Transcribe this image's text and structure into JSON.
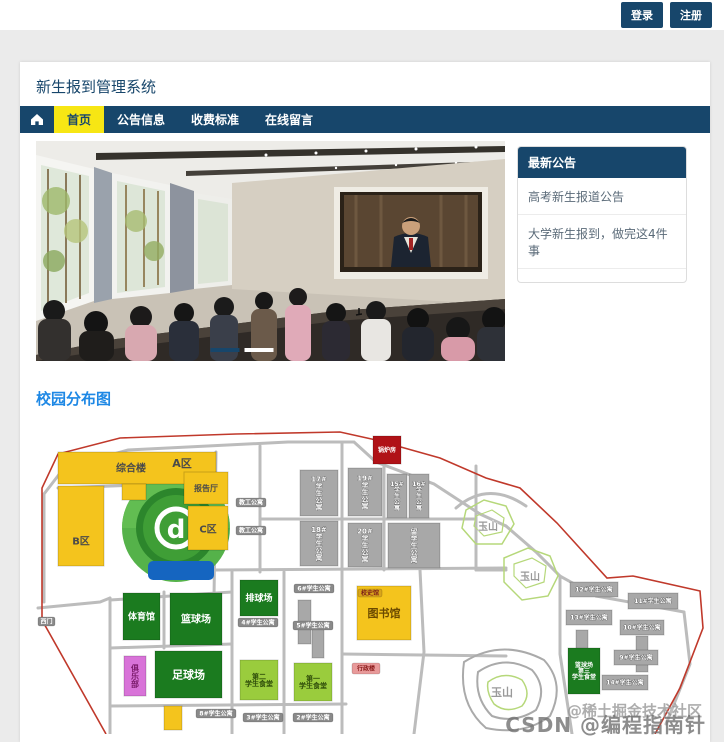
{
  "topbar": {
    "login": "登录",
    "register": "注册"
  },
  "header": {
    "title": "新生报到管理系统"
  },
  "nav": {
    "items": [
      {
        "label": "首页",
        "active": true
      },
      {
        "label": "公告信息",
        "active": false
      },
      {
        "label": "收费标准",
        "active": false
      },
      {
        "label": "在线留言",
        "active": false
      }
    ]
  },
  "carousel": {
    "slide_count": 2,
    "active_slide": 1
  },
  "announcements": {
    "title": "最新公告",
    "items": [
      "高考新生报道公告",
      "大学新生报到，做完这4件事"
    ]
  },
  "map_section": {
    "title": "校园分布图"
  },
  "campus_map": {
    "buildings": [
      {
        "x": 22,
        "y": 30,
        "w": 158,
        "h": 32,
        "c": "y"
      },
      {
        "x": 22,
        "y": 64,
        "w": 46,
        "h": 80,
        "c": "y"
      },
      {
        "x": 86,
        "y": 62,
        "w": 24,
        "h": 16,
        "c": "y"
      },
      {
        "x": 148,
        "y": 50,
        "w": 44,
        "h": 32,
        "c": "y"
      },
      {
        "x": 152,
        "y": 84,
        "w": 40,
        "h": 44,
        "c": "y"
      },
      {
        "l": "综合楼",
        "x": 95,
        "y": 46,
        "c": "ty",
        "fs": 10
      },
      {
        "l": "A区",
        "x": 146,
        "y": 41,
        "c": "ty",
        "fs": 11
      },
      {
        "l": "报告厅",
        "x": 170,
        "y": 66,
        "c": "ty",
        "fs": 8
      },
      {
        "l": "C区",
        "x": 172,
        "y": 107,
        "c": "ty",
        "fs": 10
      },
      {
        "l": "B区",
        "x": 45,
        "y": 119,
        "c": "ty",
        "fs": 10
      },
      {
        "l": "锅炉房",
        "x": 337,
        "y": 14,
        "w": 28,
        "h": 28,
        "c": "r",
        "fs": 6
      },
      {
        "l": "17#学生公寓",
        "x": 264,
        "y": 48,
        "w": 38,
        "h": 46,
        "c": "g",
        "v": 1,
        "fs": 7
      },
      {
        "l": "19#学生公寓",
        "x": 312,
        "y": 46,
        "w": 34,
        "h": 48,
        "c": "g",
        "v": 1,
        "fs": 7
      },
      {
        "l": "15#学生公寓",
        "x": 351,
        "y": 52,
        "w": 20,
        "h": 44,
        "c": "g",
        "v": 1,
        "fs": 6
      },
      {
        "l": "16#学生公寓",
        "x": 373,
        "y": 52,
        "w": 20,
        "h": 44,
        "c": "g",
        "v": 1,
        "fs": 6
      },
      {
        "l": "18#学生公寓",
        "x": 264,
        "y": 99,
        "w": 38,
        "h": 45,
        "c": "g",
        "v": 1,
        "fs": 7
      },
      {
        "l": "20#学生公寓",
        "x": 312,
        "y": 101,
        "w": 34,
        "h": 44,
        "c": "g",
        "v": 1,
        "fs": 7
      },
      {
        "l": "留学生公寓",
        "x": 352,
        "y": 101,
        "w": 52,
        "h": 45,
        "c": "g",
        "v": 1,
        "fs": 7
      },
      {
        "x": 262,
        "y": 178,
        "w": 13,
        "h": 44,
        "c": "g"
      },
      {
        "x": 276,
        "y": 204,
        "w": 12,
        "h": 32,
        "c": "g"
      },
      {
        "x": 540,
        "y": 208,
        "w": 12,
        "h": 36,
        "c": "g"
      },
      {
        "x": 600,
        "y": 214,
        "w": 12,
        "h": 36,
        "c": "g"
      },
      {
        "l": "12#学生公寓",
        "x": 534,
        "y": 160,
        "w": 48,
        "h": 15,
        "c": "g",
        "fs": 6
      },
      {
        "l": "11#学生公寓",
        "x": 592,
        "y": 171,
        "w": 50,
        "h": 16,
        "c": "g",
        "fs": 6
      },
      {
        "l": "13#学生公寓",
        "x": 530,
        "y": 188,
        "w": 46,
        "h": 15,
        "c": "g",
        "fs": 6
      },
      {
        "l": "10#学生公寓",
        "x": 584,
        "y": 198,
        "w": 44,
        "h": 15,
        "c": "g",
        "fs": 6
      },
      {
        "l": "9#学生公寓",
        "x": 578,
        "y": 228,
        "w": 44,
        "h": 15,
        "c": "g",
        "fs": 6
      },
      {
        "l": "14#学生公寓",
        "x": 566,
        "y": 253,
        "w": 46,
        "h": 15,
        "c": "g",
        "fs": 6
      },
      {
        "l": "体育馆",
        "x": 87,
        "y": 171,
        "w": 37,
        "h": 47,
        "c": "dg",
        "fs": 9
      },
      {
        "l": "篮球场",
        "x": 134,
        "y": 171,
        "w": 52,
        "h": 52,
        "c": "dg",
        "fs": 10
      },
      {
        "l": "排球场",
        "x": 204,
        "y": 158,
        "w": 38,
        "h": 36,
        "c": "dg",
        "fs": 9
      },
      {
        "l": "足球场",
        "x": 119,
        "y": 229,
        "w": 67,
        "h": 47,
        "c": "dg",
        "fs": 11
      },
      {
        "l": "篮球场|第三|学生食堂",
        "x": 532,
        "y": 226,
        "w": 32,
        "h": 46,
        "c": "dg",
        "fs": 6
      },
      {
        "l": "第二|学生食堂",
        "x": 204,
        "y": 238,
        "w": 38,
        "h": 40,
        "c": "lg",
        "fs": 7
      },
      {
        "l": "第一|学生食堂",
        "x": 258,
        "y": 241,
        "w": 38,
        "h": 38,
        "c": "lg",
        "fs": 7
      },
      {
        "l": "俱乐部",
        "x": 88,
        "y": 234,
        "w": 22,
        "h": 40,
        "c": "p",
        "v": 1,
        "fs": 8
      },
      {
        "l": "图书馆",
        "x": 321,
        "y": 164,
        "w": 54,
        "h": 54,
        "c": "y",
        "fs": 11
      },
      {
        "x": 128,
        "y": 284,
        "w": 18,
        "h": 24,
        "c": "y"
      }
    ],
    "pills": [
      {
        "l": "西门",
        "x": 2,
        "y": 195,
        "w": 17,
        "h": 9
      },
      {
        "l": "教工公寓",
        "x": 200,
        "y": 76,
        "w": 30,
        "h": 9
      },
      {
        "l": "教工公寓",
        "x": 200,
        "y": 104,
        "w": 30,
        "h": 9
      },
      {
        "l": "6#学生公寓",
        "x": 258,
        "y": 162,
        "w": 40,
        "h": 9
      },
      {
        "l": "4#学生公寓",
        "x": 202,
        "y": 196,
        "w": 40,
        "h": 9
      },
      {
        "l": "5#学生公寓",
        "x": 257,
        "y": 199,
        "w": 40,
        "h": 9
      },
      {
        "l": "8#学生公寓",
        "x": 160,
        "y": 287,
        "w": 40,
        "h": 9
      },
      {
        "l": "3#学生公寓",
        "x": 207,
        "y": 291,
        "w": 40,
        "h": 9
      },
      {
        "l": "2#学生公寓",
        "x": 257,
        "y": 291,
        "w": 40,
        "h": 9
      },
      {
        "l": "校史馆",
        "x": 322,
        "y": 167,
        "w": 24,
        "h": 8,
        "bg": "#d9a51a",
        "tc": "#7a1a1a"
      },
      {
        "l": "行政楼",
        "x": 316,
        "y": 241,
        "w": 28,
        "h": 11,
        "bg": "#e89a9a",
        "tc": "#8a1a1a"
      }
    ],
    "mountains": [
      {
        "label": "玉山",
        "x": 452,
        "y": 108,
        "fs": 10
      },
      {
        "label": "玉山",
        "x": 494,
        "y": 158,
        "fs": 10
      },
      {
        "label": "玉山",
        "x": 466,
        "y": 274,
        "fs": 11
      }
    ]
  },
  "watermark": {
    "line1": "@稀土掘金技术社区",
    "line2": "CSDN @编程指南针"
  },
  "colors": {
    "navy": "#17466b",
    "nav_yellow": "#f7e614",
    "yellow": "#f4c41d",
    "dark_green": "#1b7b1f",
    "light_green": "#9acc3d",
    "gray_building": "#a8a8a8",
    "red_building": "#b01217",
    "pink_building": "#d873d8",
    "blue_strip": "#1565c0",
    "link_blue": "#1e88e5",
    "boundary_red": "#c0392b",
    "road_gray": "#bcbcbc"
  }
}
